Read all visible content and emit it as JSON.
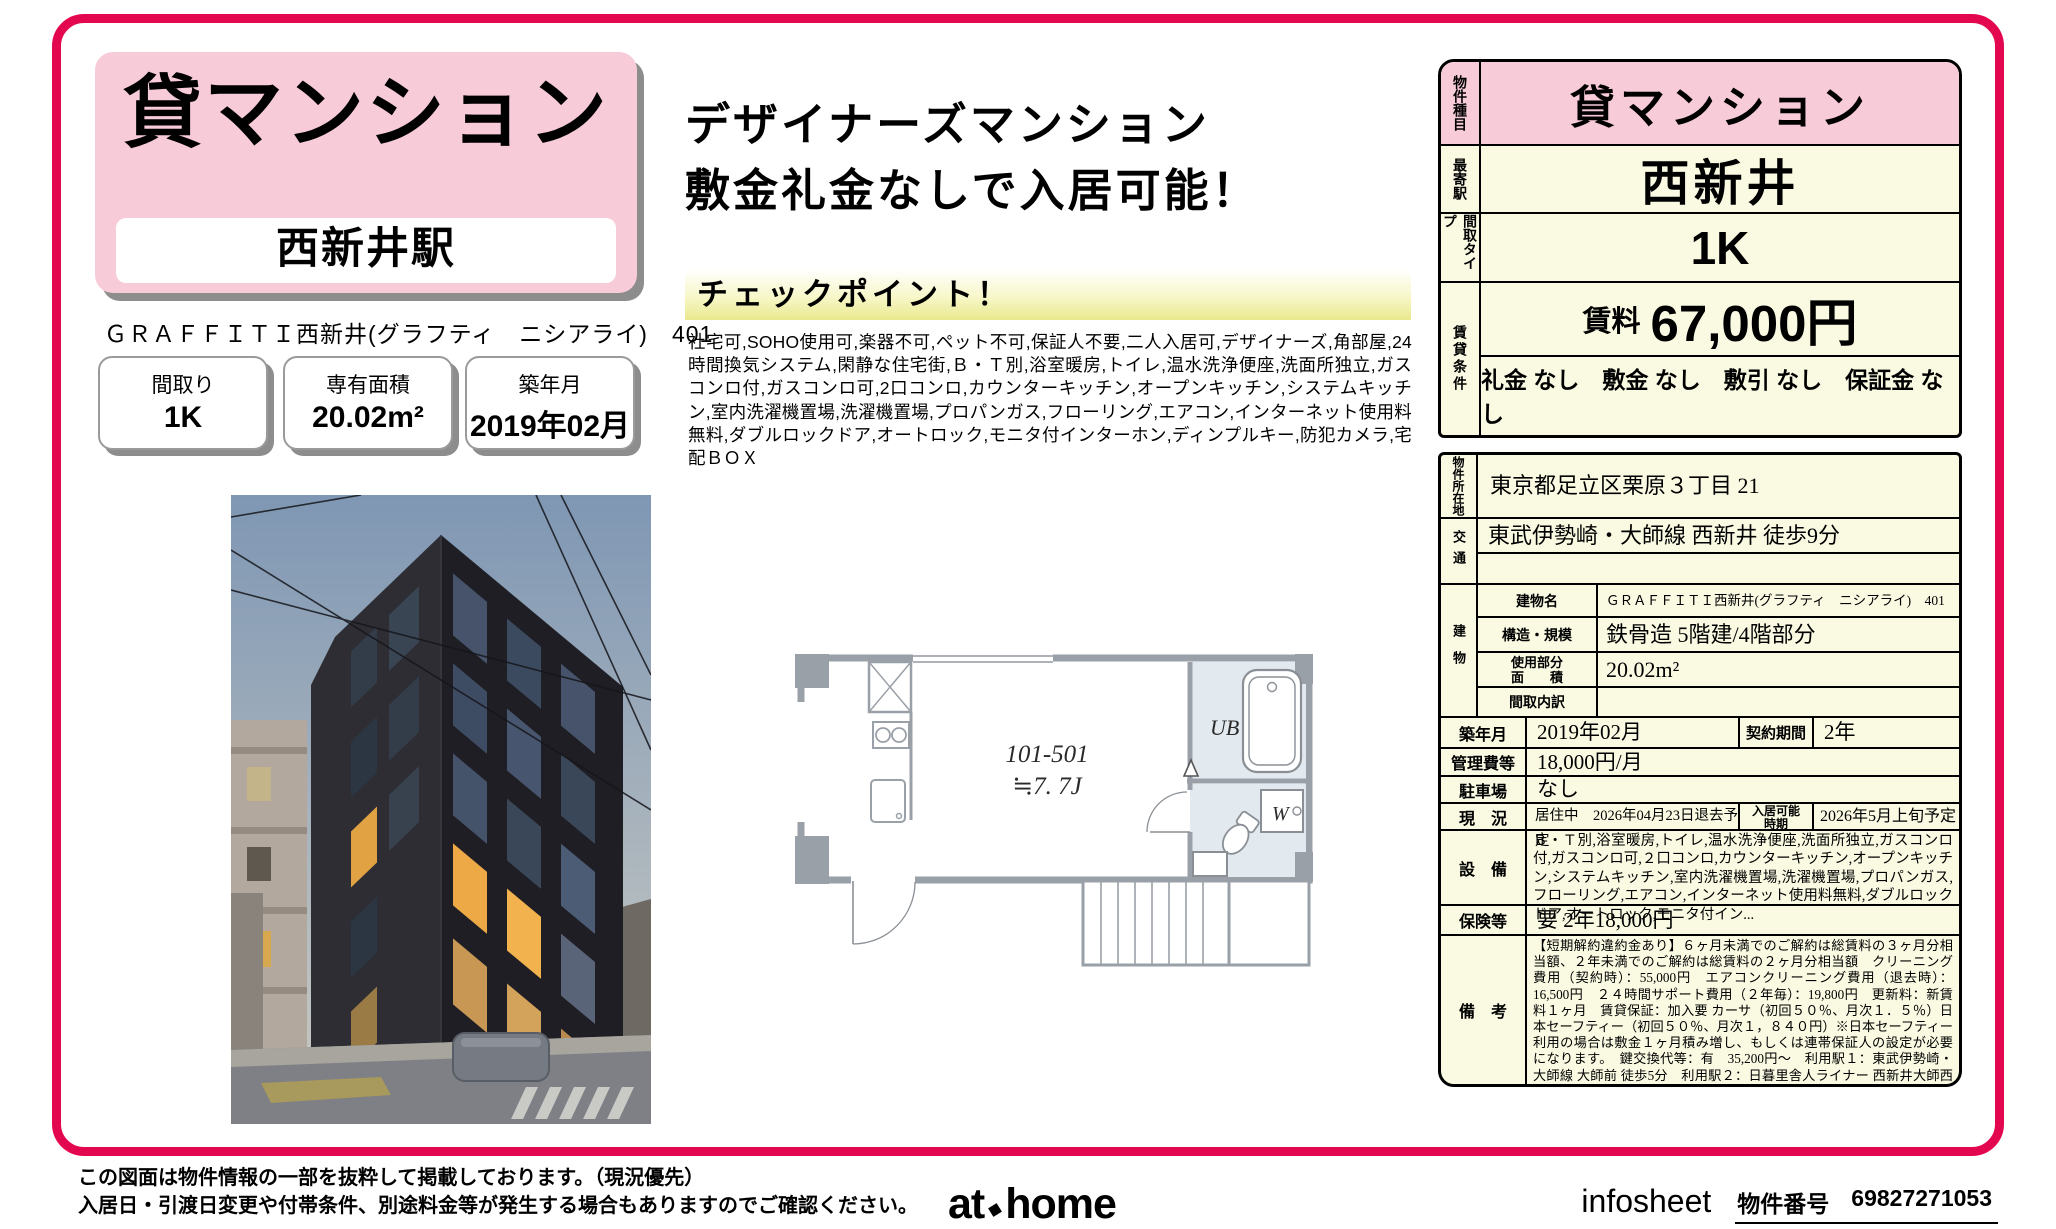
{
  "header": {
    "category": "貸マンション",
    "station": "西新井駅",
    "property_line": "ＧＲＡＦＦＩＴＩ西新井(グラフティ　ニシアライ)　401",
    "spec_boxes": [
      {
        "label": "間取り",
        "value": "1K"
      },
      {
        "label": "専有面積",
        "value": "20.02m²"
      },
      {
        "label": "築年月",
        "value": "2019年02月"
      }
    ]
  },
  "promo": {
    "headline1": "デザイナーズマンション",
    "headline2": "敷金礼金なしで入居可能！",
    "checkpoint_title": "チェックポイント！",
    "features": "社宅可,SOHO使用可,楽器不可,ペット不可,保証人不要,二人入居可,デザイナーズ,角部屋,24時間換気システム,閑静な住宅街,Ｂ・Ｔ別,浴室暖房,トイレ,温水洗浄便座,洗面所独立,ガスコンロ付,ガスコンロ可,2口コンロ,カウンターキッチン,オープンキッチン,システムキッチン,室内洗濯機置場,洗濯機置場,プロパンガス,フローリング,エアコン,インターネット使用料無料,ダブルロックドア,オートロック,モニタ付インターホン,ディンプルキー,防犯カメラ,宅配ＢＯＸ"
  },
  "summary": {
    "property_type_label": "物件種目",
    "property_type": "貸マンション",
    "station_label": "最寄駅",
    "station": "西新井",
    "layout_label": "間取タイプ",
    "layout": "1K",
    "conditions_label": "賃貸条件",
    "rent_label": "賃料",
    "rent": "67,000円",
    "conditions": "礼金 なし　敷金 なし　敷引 なし　保証金 なし"
  },
  "details": {
    "location_label": "物件所在地",
    "location": "東京都足立区栗原３丁目 21",
    "transport_label": "交通",
    "transport": "東武伊勢崎・大師線 西新井 徒歩9分",
    "building_label": "建物",
    "building_name_label": "建物名",
    "building_name": "ＧＲＡＦＦＩＴＩ西新井(グラフティ　ニシアライ)　401",
    "structure_label": "構造・規模",
    "structure": "鉄骨造 5階建/4階部分",
    "area_label1": "使用部分",
    "area_label2": "面　　積",
    "area": "20.02m²",
    "layout_detail_label": "間取内訳",
    "layout_detail": "",
    "built_label": "築年月",
    "built": "2019年02月",
    "contract_label": "契約期間",
    "contract": "2年",
    "fee_label": "管理費等",
    "fee": "18,000円/月",
    "parking_label": "駐車場",
    "parking": "なし",
    "status_label": "現　況",
    "status": "居住中　2026年04月23日退去予定",
    "movein_label1": "入居可能",
    "movein_label2": "時期",
    "movein": "2026年5月上旬予定",
    "equipment_label": "設　備",
    "equipment": "Ｂ・Ｔ別,浴室暖房,トイレ,温水洗浄便座,洗面所独立,ガスコンロ付,ガスコンロ可,２口コンロ,カウンターキッチン,オープンキッチン,システムキッチン,室内洗濯機置場,洗濯機置場,プロパンガス,フローリング,エアコン,インターネット使用料無料,ダブルロックドア,オートロック,モニタ付イン...",
    "insurance_label": "保険等",
    "insurance": "要 2年18,000円",
    "notes_label": "備　考",
    "notes": "【短期解約違約金あり】６ヶ月未満でのご解約は総賃料の３ヶ月分相当額、２年未満でのご解約は総賃料の２ヶ月分相当額　クリーニング費用（契約時）：55,000円　エアコンクリーニング費用（退去時）：16,500円　２４時間サポート費用（２年毎）：19,800円　更新料：新賃料１ヶ月　賃貸保証：加入要 カーサ（初回５０％、月次１．５％）日本セーフティー（初回５０％、月次１，８４０円）※日本セーフティー利用の場合は敷金１ヶ月積み増し、もしくは連帯保証人の設定が必要になります。　鍵交換代等：有　35,200円～　利用駅１：東武伊勢崎・大師線 大師前 徒歩5分　利用駅２：日暮里舎人ライナー 西新井大師西 徒歩2分"
  },
  "floor_plan": {
    "unit_label": "101-501",
    "size_label": "≒7. 7J",
    "bath_label": "UB",
    "washer_label": "W"
  },
  "footer": {
    "disclaimer1": "この図面は物件情報の一部を抜粋して掲載しております。（現況優先）",
    "disclaimer2": "入居日・引渡日変更や付帯条件、別途料金等が発生する場合もありますのでご確認ください。",
    "logo_at": "at",
    "logo_home": "home",
    "infosheet": "infosheet",
    "property_no_label": "物件番号",
    "property_no": "69827271053"
  },
  "colors": {
    "accent_pink": "#f8cbd8",
    "border_crimson": "#e3074f",
    "table_cream": "#fafae3"
  }
}
